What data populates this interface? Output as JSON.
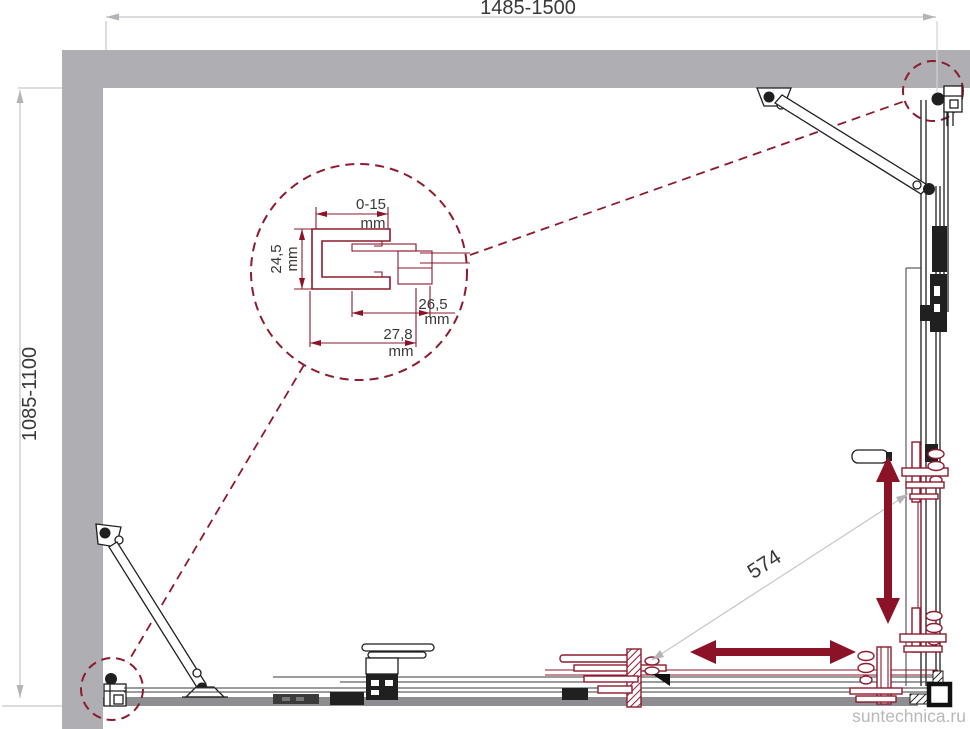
{
  "drawing": {
    "overall": {
      "width_range": "1485-1500",
      "depth_range": "1085-1100",
      "diagonal_adjust": "574"
    },
    "profile_detail": {
      "dims": [
        {
          "id": "wall-gap",
          "value": "0-15",
          "unit": "mm"
        },
        {
          "id": "profile-height",
          "value": "24,5",
          "unit": "mm"
        },
        {
          "id": "inner-width",
          "value": "26,5",
          "unit": "mm"
        },
        {
          "id": "outer-width",
          "value": "27,8",
          "unit": "mm"
        }
      ]
    },
    "watermark": "suntechnica.ru",
    "colors": {
      "accent_maroon": "#8d1a2e",
      "arrow_red": "#8c1228",
      "wall_gray": "#aeaeb3",
      "floor_gray": "#8e8e92",
      "dim_line_gray": "#c6c6ca",
      "text_dark": "#383838",
      "watermark_gray": "#b8b8b8"
    }
  }
}
